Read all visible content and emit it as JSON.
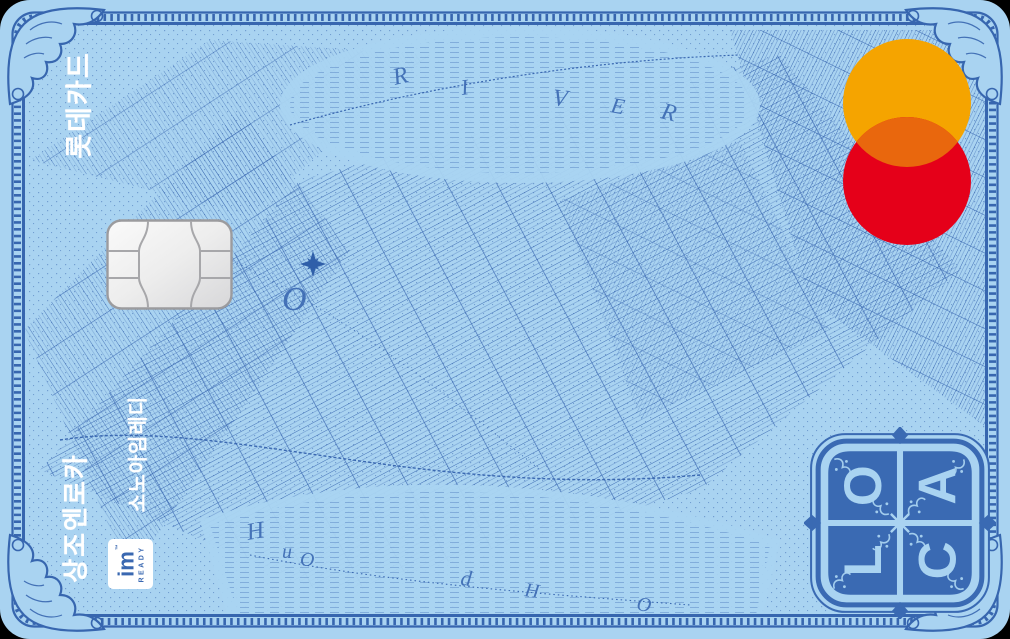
{
  "card": {
    "type": "credit-card-front",
    "issuer_vertical_text": "롯데카드",
    "product_vertical_text": "상조엔로카",
    "partner_vertical_text": "소노아임레디",
    "ready_badge": {
      "logo_text": "im",
      "trademark": "™",
      "sub_text": "READY"
    },
    "network": {
      "name": "mastercard",
      "icon": "mastercard-circles-icon",
      "orange": "#F5A400",
      "red": "#E50019",
      "overlap": "#E9670D"
    },
    "chip": {
      "icon": "emv-chip-icon"
    },
    "loca_logo": {
      "letters": [
        "L",
        "O",
        "C",
        "A"
      ]
    },
    "map": {
      "style": "vintage-city-map-engraving",
      "letters_top": [
        "R",
        "I",
        "V",
        "E",
        "R"
      ],
      "letters_bottom": [
        "H",
        "u",
        "O",
        "d",
        "H",
        "O"
      ],
      "letter_mid": "O",
      "star_icon": "compass-star-icon"
    },
    "colors": {
      "background": "#A9D3F1",
      "map_ink": "#3A68B1",
      "frame": "#3766AF",
      "text": "#FFFFFF"
    }
  }
}
